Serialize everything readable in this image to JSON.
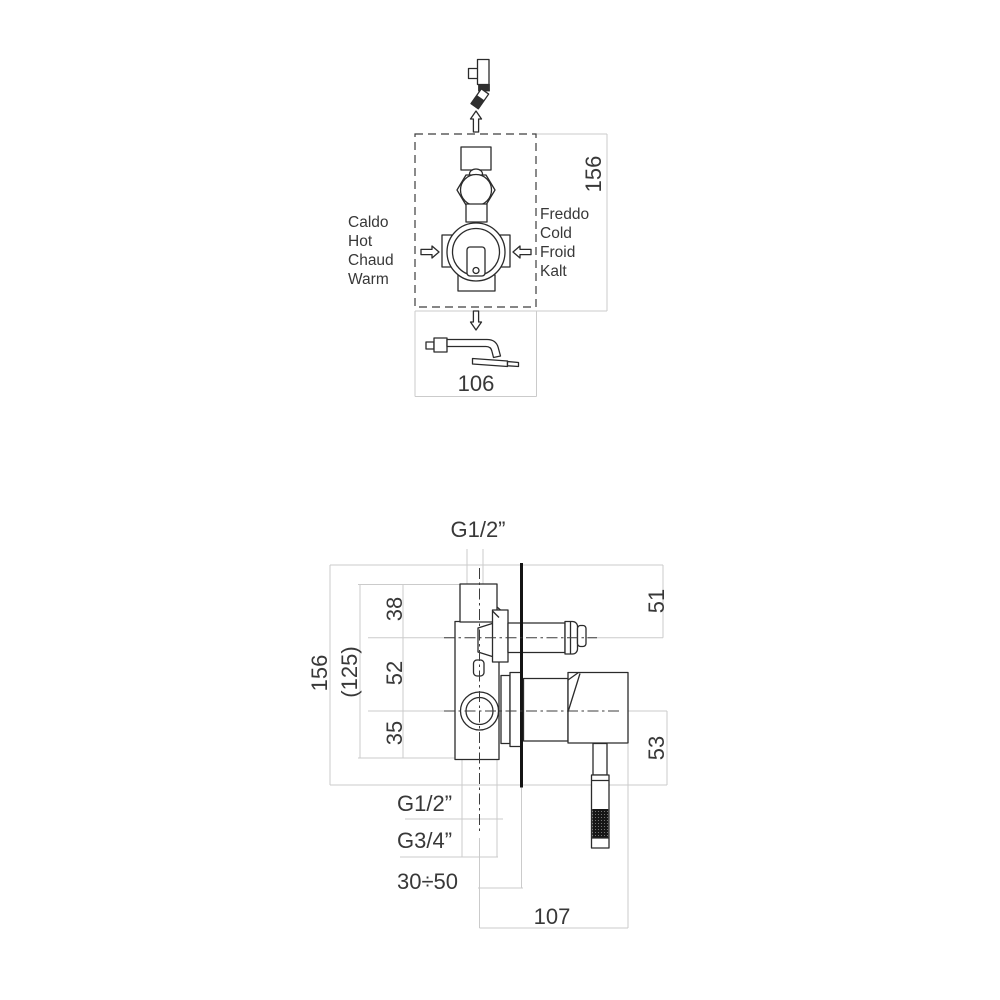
{
  "colors": {
    "background": "#ffffff",
    "line": "#2b2b2b",
    "dimension_line": "#cbcbcb",
    "text": "#383838",
    "wall_line": "#141414"
  },
  "top_view": {
    "hot_labels": [
      "Caldo",
      "Hot",
      "Chaud",
      "Warm"
    ],
    "cold_labels": [
      "Freddo",
      "Cold",
      "Froid",
      "Kalt"
    ],
    "height_dim": "156",
    "width_dim": "106"
  },
  "side_view": {
    "top_thread": "G1/2”",
    "seg_38": "38",
    "seg_52": "52",
    "seg_35": "35",
    "overall": "156",
    "body_overall": "(125)",
    "upper_right": "51",
    "lower_right": "53",
    "outlet_thread": "G1/2”",
    "spout_thread": "G3/4”",
    "depth_range": "30÷50",
    "bottom_width": "107"
  }
}
